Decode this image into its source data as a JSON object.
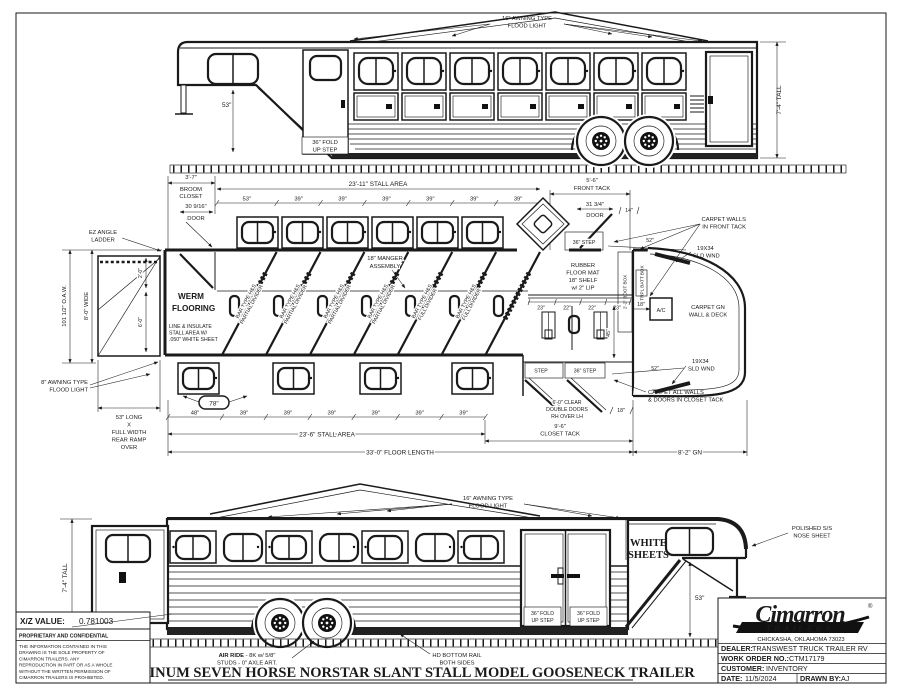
{
  "colors": {
    "ink": "#1a1a1a",
    "paper": "#ffffff"
  },
  "top_view": {
    "flood_light": [
      "16\" AWNING TYPE",
      "FLOOD LIGHT"
    ],
    "dim_53": "53\"",
    "fold_step": [
      "36\" FOLD",
      "UP STEP"
    ],
    "tall": "7'-4\" TALL"
  },
  "plan": {
    "broom": [
      "3'-7\"",
      "BROOM",
      "CLOSET"
    ],
    "door30": [
      "30 9/16\"",
      "DOOR"
    ],
    "stall_area_top": "23'-11\" STALL AREA",
    "front_tack": [
      "5'-6\"",
      "FRONT TACK"
    ],
    "top_dims": [
      "53\"",
      "39\"",
      "39\"",
      "39\"",
      "39\"",
      "39\"",
      "39\""
    ],
    "door31": [
      "31 3/4\"",
      "DOOR"
    ],
    "dim14": "14\"",
    "step36_front": "36\" STEP",
    "ez_ladder": [
      "EZ ANGLE",
      "LADDER"
    ],
    "manger": [
      "18\" MANGER",
      "ASSEMBLY"
    ],
    "carpet_front": [
      "CARPET WALLS",
      "IN FRONT TACK"
    ],
    "wnd": [
      "19X34",
      "SLD WND"
    ],
    "dim52": "52\"",
    "boot_box": "2'-2\" BOOT BOX",
    "trpl_batt": "TRPL BATT BOX",
    "ac": "A/C",
    "dim18ac": "18\"",
    "carpet_gn": [
      "CARPET GN",
      "WALL & DECK"
    ],
    "werm": [
      "WERM",
      "FLOORING"
    ],
    "insulate": [
      "LINE & INSULATE",
      "STALL AREA W/",
      ".050\" WHITE SHEET"
    ],
    "divider_partial": [
      "BAR TYPE H&S",
      "PARTIAL DIVIDER"
    ],
    "divider_full": [
      "BAR TYPE H&S",
      "FULL DIVIDER"
    ],
    "oaw": "101 1/2\" O.A.W.",
    "wide": "8'-0\" WIDE",
    "dim20": "2'-0\"",
    "dim60": "6'-0\"",
    "awning8": [
      "8\" AWNING TYPE",
      "FLOOD LIGHT"
    ],
    "ramp": [
      "53\" LONG",
      "X",
      "FULL WIDTH",
      "REAR RAMP",
      "OVER"
    ],
    "rubber": [
      "RUBBER",
      "FLOOR MAT",
      "18\" SHELF",
      "w/ 2\" LIP"
    ],
    "shelf_dims": [
      "23\"",
      "22\"",
      "22\"",
      "23\""
    ],
    "dim45": "45\"",
    "step": "STEP",
    "step36": "36\" STEP",
    "clear_doors": [
      "6'-0\" CLEAR",
      "DOUBLE DOORS",
      "RH OVER LH"
    ],
    "dim18": "18\"",
    "carpet_closet": [
      "CARPET ALL WALLS",
      "& DOORS IN CLOSET TACK"
    ],
    "closet_tack": [
      "9'-6\"",
      "CLOSET TACK"
    ],
    "stall_area_bottom": "23'-6\" STALL AREA",
    "floor_length": "33'-0\" FLOOR LENGTH",
    "gn": "8'-2\" GN",
    "bottom_dims": [
      "48\"",
      "39\"",
      "39\"",
      "39\"",
      "39\"",
      "39\"",
      "39\""
    ],
    "oval78": "78\""
  },
  "bottom_view": {
    "flood_light": [
      "16\" AWNING TYPE",
      "FLOOD LIGHT"
    ],
    "white_sheets": [
      "WHITE",
      "SHEETS"
    ],
    "polished": [
      "POLISHED S/S",
      "NOSE SHEET"
    ],
    "dim53": "53\"",
    "fold_step": [
      "36\" FOLD",
      "UP STEP"
    ],
    "tall": "7'-4\" TALL"
  },
  "footer": {
    "xz_label": "X/Z VALUE:",
    "xz_value": "0.781003",
    "prop_title": "PROPRIETARY AND CONFIDENTIAL",
    "prop_lines": [
      "THE INFORMATION CONTAINED IN THIS",
      "DRAWING IS THE SOLE PROPERTY OF",
      "CIMARRON TRAILERS.  ANY",
      "REPRODUCTION IN PART OR AS A WHOLE",
      "WITHOUT THE WRITTEN PERMISSION OF",
      "CIMARRON TRAILERS IS PROHIBITED."
    ],
    "air_ride_bold": "AIR RIDE",
    "air_ride_rest": " - 8K w/ 5/8\"",
    "air_ride_line2": "STUDS - 0\" AXLE ART.",
    "hd_rail": [
      "HD BOTTOM RAIL",
      "BOTH SIDES"
    ],
    "main_title": "ALUMINUM SEVEN HORSE NORSTAR SLANT STALL MODEL GOOSENECK TRAILER"
  },
  "title_block": {
    "brand": "Cimarron",
    "brand_sub": "TRAILERS",
    "reg": "®",
    "address": "CHICKASHA, OKLAHOMA 73023",
    "dealer_label": "DEALER:",
    "dealer": "TRANSWEST TRUCK TRAILER RV",
    "wo_label": "WORK ORDER NO.:",
    "wo": "CTM17179",
    "customer_label": "CUSTOMER:",
    "customer": "INVENTORY",
    "date_label": "DATE:",
    "date": "11/5/2024",
    "drawn_label": "DRAWN BY:",
    "drawn": "AJ"
  }
}
